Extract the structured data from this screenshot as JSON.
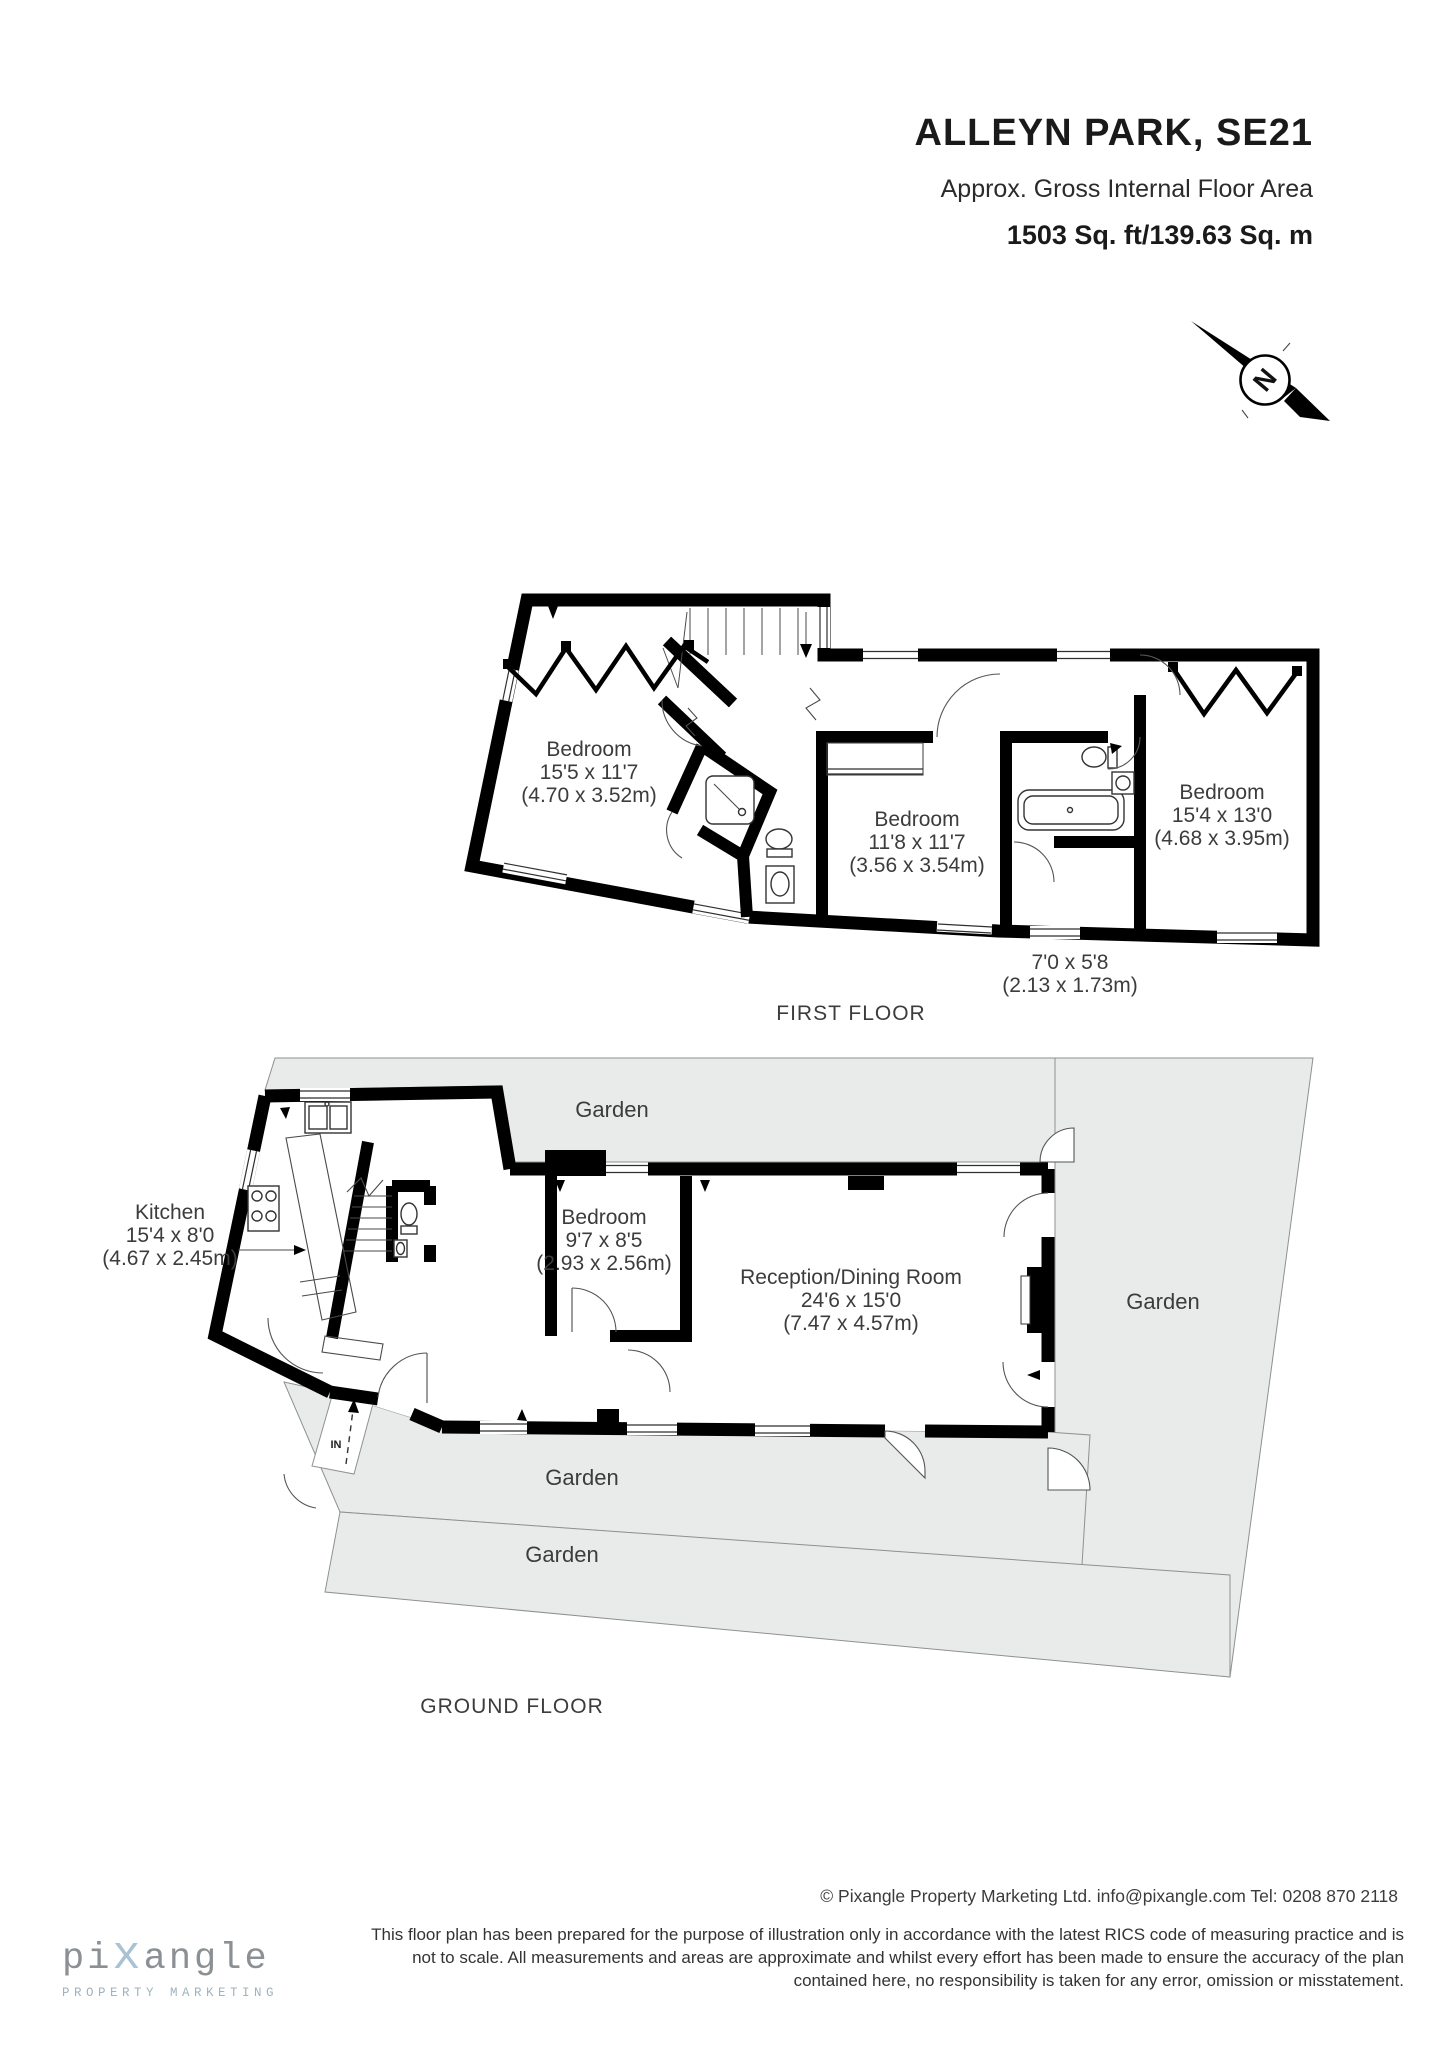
{
  "header": {
    "title": "ALLEYN PARK, SE21",
    "subtitle": "Approx. Gross Internal Floor Area",
    "area": "1503 Sq. ft/139.63 Sq. m"
  },
  "compass": {
    "north": "N"
  },
  "colors": {
    "wall": "#000000",
    "garden_fill": "#e9eaea",
    "garden_stroke": "#8e9191",
    "text": "#3c3c3c",
    "logo_gray": "#8a9094",
    "logo_blue": "#a9c3d4"
  },
  "first_floor": {
    "caption": "FIRST FLOOR",
    "bedroom_left": {
      "name": "Bedroom",
      "dims_ft": "15'5 x 11'7",
      "dims_m": "(4.70 x 3.52m)"
    },
    "bedroom_middle": {
      "name": "Bedroom",
      "dims_ft": "11'8 x 11'7",
      "dims_m": "(3.56 x 3.54m)"
    },
    "bedroom_right": {
      "name": "Bedroom",
      "dims_ft": "15'4 x 13'0",
      "dims_m": "(4.68 x 3.95m)"
    },
    "store_room": {
      "dims_ft": "7'0 x 5'8",
      "dims_m": "(2.13 x 1.73m)"
    }
  },
  "ground_floor": {
    "caption": "GROUND FLOOR",
    "kitchen": {
      "name": "Kitchen",
      "dims_ft": "15'4 x 8'0",
      "dims_m": "(4.67 x 2.45m)"
    },
    "bedroom": {
      "name": "Bedroom",
      "dims_ft": "9'7 x 8'5",
      "dims_m": "(2.93 x 2.56m)"
    },
    "reception": {
      "name": "Reception/Dining Room",
      "dims_ft": "24'6 x 15'0",
      "dims_m": "(7.47 x 4.57m)"
    },
    "garden_top": "Garden",
    "garden_right": "Garden",
    "garden_back": "Garden",
    "garden_front": "Garden",
    "entrance": "IN"
  },
  "footer": {
    "logo": {
      "part1": "pi",
      "part2": "x",
      "part3": "angle",
      "tagline": "PROPERTY MARKETING"
    },
    "copyright": "© Pixangle Property Marketing Ltd. info@pixangle.com Tel: 0208 870 2118",
    "disclaimer_line1": "This floor plan has been prepared for the purpose of illustration only in accordance with the latest RICS code of measuring practice and is",
    "disclaimer_line2": "not to scale. All measurements and areas are approximate and whilst every effort has been made to ensure the accuracy of the plan",
    "disclaimer_line3": "contained here, no responsibility is taken for any error, omission or misstatement."
  }
}
